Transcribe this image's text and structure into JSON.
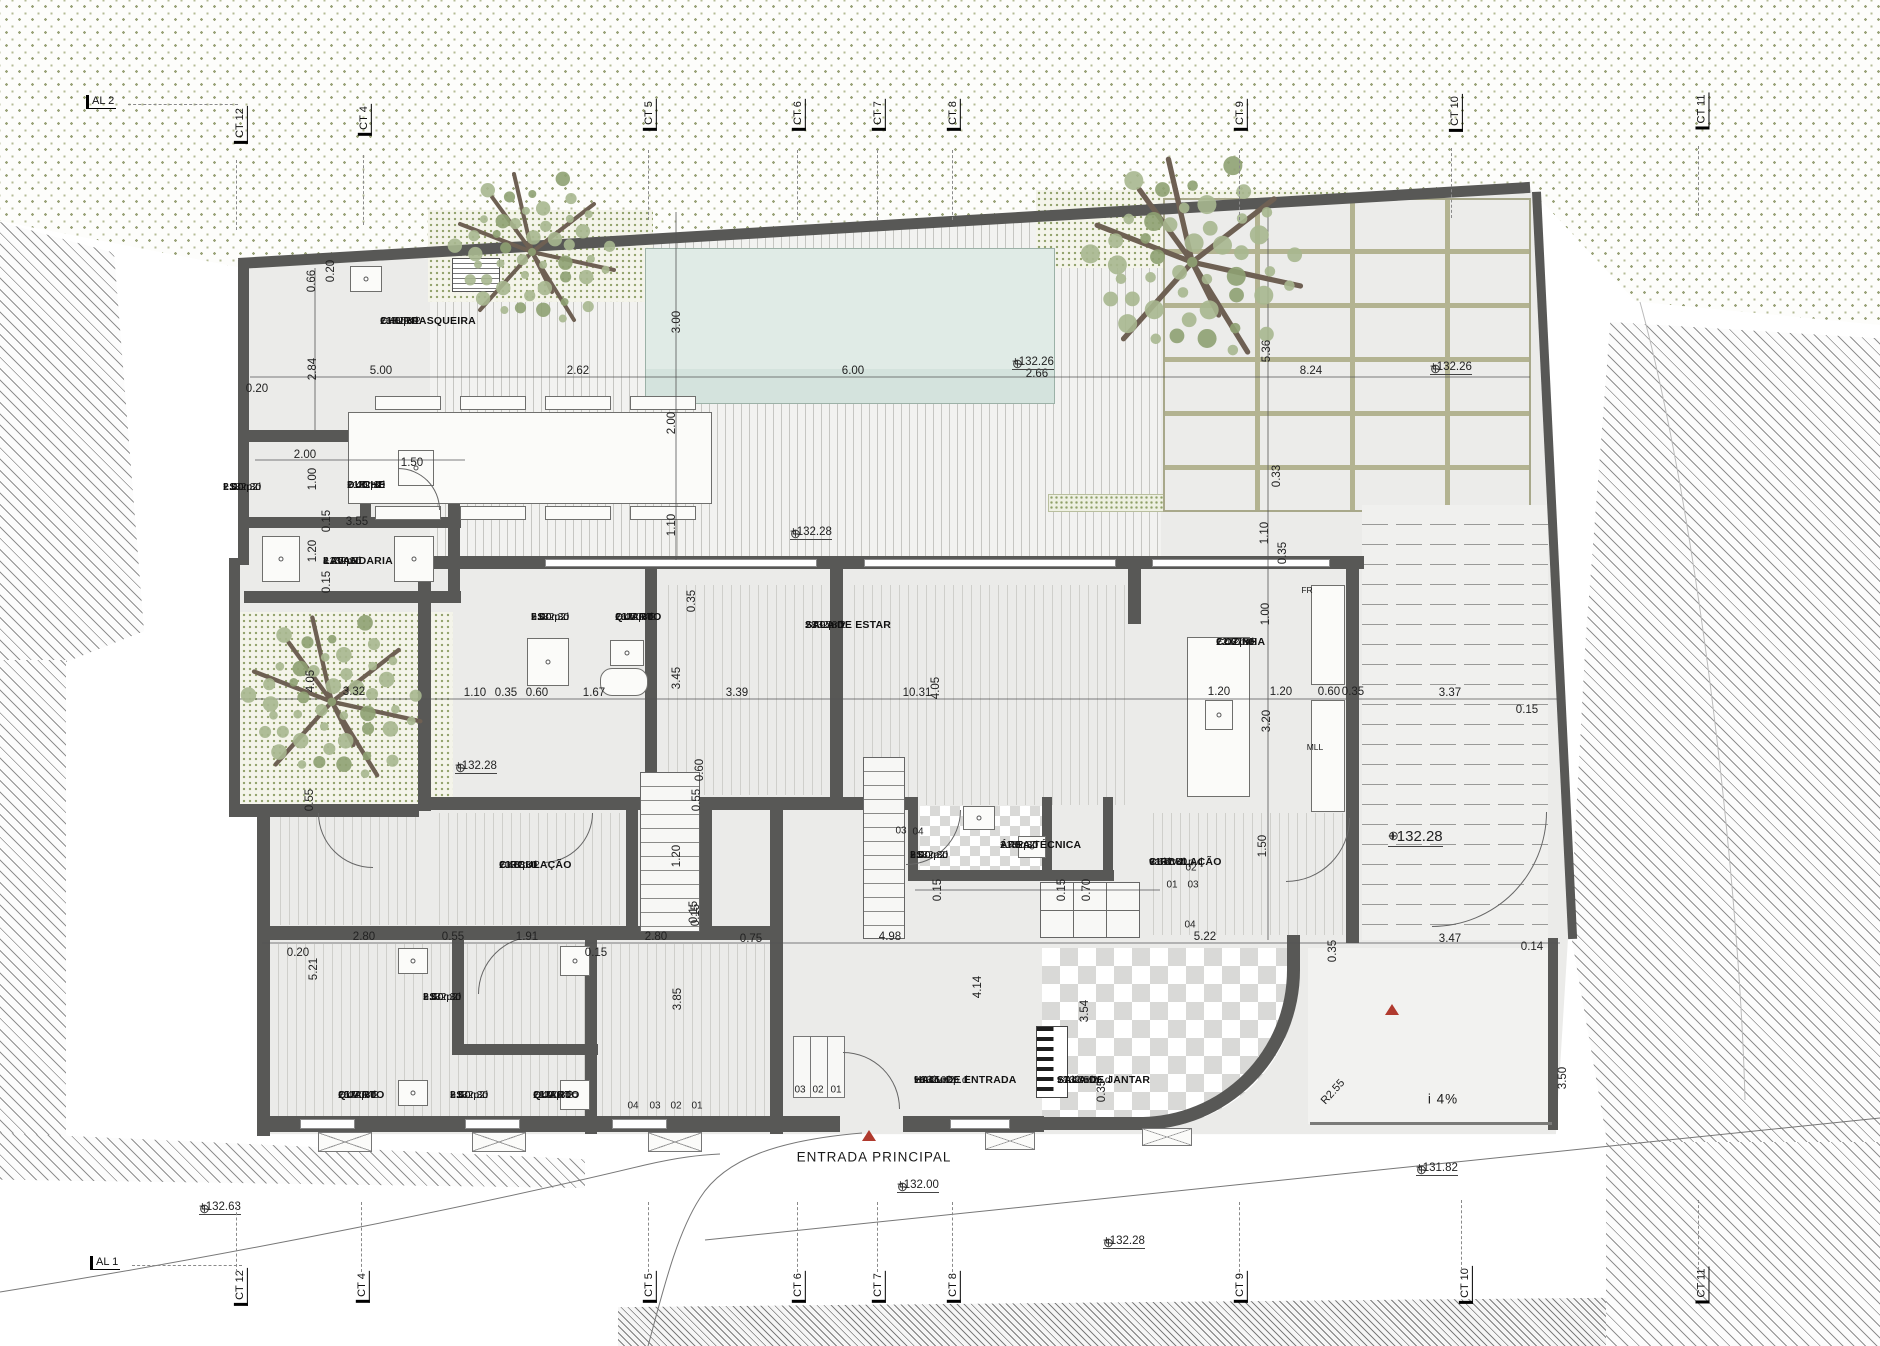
{
  "rooms": [
    {
      "name": "CHURRASQUEIRA",
      "area": "16.85m2",
      "pd": "2.40  p.d",
      "level": "+132.30",
      "x": 455,
      "y": 316
    },
    {
      "name": "I.S.",
      "area": "2.00m2",
      "pd": "2.40  p.d",
      "level": "+132.30",
      "x": 298,
      "y": 482
    },
    {
      "name": "DUCHE",
      "area": "1.45m2",
      "pd": "2.40  p.d",
      "level": "+132.30",
      "x": 422,
      "y": 480
    },
    {
      "name": "LAVANDARIA",
      "area": "4.25m2",
      "pd": "2.40  p.d",
      "level": "+132.30",
      "x": 398,
      "y": 556
    },
    {
      "name": "I.S.",
      "area": "5.00m2",
      "pd": "2.40  p.d",
      "level": "+132.30",
      "x": 606,
      "y": 612
    },
    {
      "name": "QUARTO",
      "area": "16.50m2",
      "pd": "2.40  p.d",
      "level": "+132.30",
      "x": 690,
      "y": 612
    },
    {
      "name": "SALA DE ESTAR",
      "area": "28.95m2",
      "pd": "2.40  p.d",
      "level": "+132.30",
      "x": 880,
      "y": 620
    },
    {
      "name": "COZINHA",
      "area": "12.37m2",
      "pd": "2.40  p.d",
      "level": "+132.30",
      "x": 1291,
      "y": 637
    },
    {
      "name": "CIRCULAÇÃO",
      "area": "10.38m2",
      "pd": "2.40  p.d",
      "level": "+132.30",
      "x": 574,
      "y": 860
    },
    {
      "name": "I.S.",
      "area": "3.00m2",
      "pd": "2.40  p.d",
      "level": "+132.30",
      "x": 985,
      "y": 850
    },
    {
      "name": "ÁREA TÉCNICA",
      "area": "1.43m2",
      "pd": "2.40  p.d",
      "level": "+132.30",
      "x": 1075,
      "y": 840
    },
    {
      "name": "CIRCULAÇÃO",
      "area": "9.67m2",
      "pd": "variável  p.d",
      "level": "+132.30",
      "x": 1224,
      "y": 857
    },
    {
      "name": "I.S.",
      "area": "3.50m2",
      "pd": "2.40  p.d",
      "level": "+132.30",
      "x": 498,
      "y": 992
    },
    {
      "name": "QUARTO",
      "area": "15.70m2",
      "pd": "2.40  p.d",
      "level": "+132.30",
      "x": 413,
      "y": 1090
    },
    {
      "name": "I.S.",
      "area": "3.50m2",
      "pd": "2.40  p.d",
      "level": "+132.30",
      "x": 525,
      "y": 1090
    },
    {
      "name": "QUARTO",
      "area": "11.90m2",
      "pd": "2.40  p.d",
      "level": "+132.30",
      "x": 608,
      "y": 1090
    },
    {
      "name": "HALL DE ENTRADA",
      "area": "16.45m2",
      "pd": "variável  p.d",
      "level": "+132.02",
      "x": 989,
      "y": 1075
    },
    {
      "name": "SALA DE JANTAR",
      "area": "17.43m2",
      "pd": "variável  p.d",
      "level": "+132.50",
      "x": 1132,
      "y": 1075
    }
  ],
  "dims": [
    {
      "t": "0.20",
      "x": 257,
      "y": 389
    },
    {
      "t": "5.00",
      "x": 381,
      "y": 371
    },
    {
      "t": "2.62",
      "x": 578,
      "y": 371
    },
    {
      "t": "6.00",
      "x": 853,
      "y": 371
    },
    {
      "t": "2.66",
      "x": 1037,
      "y": 374
    },
    {
      "t": "8.24",
      "x": 1311,
      "y": 371
    },
    {
      "t": "0.66",
      "x": 312,
      "y": 281,
      "r": 1
    },
    {
      "t": "0.20",
      "x": 331,
      "y": 271,
      "r": 1
    },
    {
      "t": "2.84",
      "x": 313,
      "y": 369,
      "r": 1
    },
    {
      "t": "3.00",
      "x": 677,
      "y": 322,
      "r": 1
    },
    {
      "t": "5.36",
      "x": 1267,
      "y": 351,
      "r": 1
    },
    {
      "t": "0.33",
      "x": 1277,
      "y": 476,
      "r": 1
    },
    {
      "t": "2.00",
      "x": 672,
      "y": 423,
      "r": 1
    },
    {
      "t": "1.10",
      "x": 672,
      "y": 525,
      "r": 1
    },
    {
      "t": "2.00",
      "x": 305,
      "y": 455
    },
    {
      "t": "1.50",
      "x": 412,
      "y": 463
    },
    {
      "t": "3.55",
      "x": 357,
      "y": 522
    },
    {
      "t": "0.15",
      "x": 327,
      "y": 521,
      "r": 1
    },
    {
      "t": "1.20",
      "x": 313,
      "y": 551,
      "r": 1
    },
    {
      "t": "0.15",
      "x": 327,
      "y": 582,
      "r": 1
    },
    {
      "t": "1.00",
      "x": 313,
      "y": 479,
      "r": 1
    },
    {
      "t": "3.32",
      "x": 354,
      "y": 692
    },
    {
      "t": "1.10",
      "x": 475,
      "y": 693
    },
    {
      "t": "0.35",
      "x": 506,
      "y": 693
    },
    {
      "t": "0.60",
      "x": 537,
      "y": 693
    },
    {
      "t": "1.67",
      "x": 594,
      "y": 693
    },
    {
      "t": "3.39",
      "x": 737,
      "y": 693
    },
    {
      "t": "10.31",
      "x": 917,
      "y": 693
    },
    {
      "t": "1.20",
      "x": 1219,
      "y": 692
    },
    {
      "t": "1.20",
      "x": 1281,
      "y": 692
    },
    {
      "t": "0.60",
      "x": 1329,
      "y": 692
    },
    {
      "t": "0.35",
      "x": 1353,
      "y": 692
    },
    {
      "t": "3.37",
      "x": 1450,
      "y": 693
    },
    {
      "t": "0.15",
      "x": 1527,
      "y": 710
    },
    {
      "t": "4.05",
      "x": 311,
      "y": 681,
      "r": 1
    },
    {
      "t": "3.45",
      "x": 677,
      "y": 678,
      "r": 1
    },
    {
      "t": "0.35",
      "x": 692,
      "y": 601,
      "r": 1
    },
    {
      "t": "4.05",
      "x": 936,
      "y": 688,
      "r": 1
    },
    {
      "t": "1.00",
      "x": 1266,
      "y": 614,
      "r": 1
    },
    {
      "t": "3.20",
      "x": 1267,
      "y": 721,
      "r": 1
    },
    {
      "t": "1.10",
      "x": 1265,
      "y": 533,
      "r": 1
    },
    {
      "t": "0.35",
      "x": 1283,
      "y": 553,
      "r": 1
    },
    {
      "t": "1.20",
      "x": 677,
      "y": 856,
      "r": 1
    },
    {
      "t": "0.15",
      "x": 696,
      "y": 915,
      "r": 1
    },
    {
      "t": "0.60",
      "x": 700,
      "y": 770,
      "r": 1
    },
    {
      "t": "0.55",
      "x": 310,
      "y": 800,
      "r": 1
    },
    {
      "t": "0.55",
      "x": 697,
      "y": 800,
      "r": 1
    },
    {
      "t": "1.50",
      "x": 1263,
      "y": 846,
      "r": 1
    },
    {
      "t": "0.70",
      "x": 1087,
      "y": 890,
      "r": 1
    },
    {
      "t": "0.15",
      "x": 1062,
      "y": 890,
      "r": 1
    },
    {
      "t": "0.15",
      "x": 938,
      "y": 890,
      "r": 1
    },
    {
      "t": "0.20",
      "x": 298,
      "y": 953
    },
    {
      "t": "2.80",
      "x": 364,
      "y": 937
    },
    {
      "t": "0.55",
      "x": 453,
      "y": 937
    },
    {
      "t": "1.91",
      "x": 527,
      "y": 937
    },
    {
      "t": "0.15",
      "x": 596,
      "y": 953
    },
    {
      "t": "2.80",
      "x": 656,
      "y": 937
    },
    {
      "t": "0.75",
      "x": 751,
      "y": 939
    },
    {
      "t": "4.98",
      "x": 890,
      "y": 937
    },
    {
      "t": "5.22",
      "x": 1205,
      "y": 937
    },
    {
      "t": "3.47",
      "x": 1450,
      "y": 939
    },
    {
      "t": "0.14",
      "x": 1532,
      "y": 947
    },
    {
      "t": "5.21",
      "x": 314,
      "y": 969,
      "r": 1
    },
    {
      "t": "3.85",
      "x": 678,
      "y": 999,
      "r": 1
    },
    {
      "t": "0.15",
      "x": 694,
      "y": 912,
      "r": 1
    },
    {
      "t": "4.14",
      "x": 978,
      "y": 987,
      "r": 1
    },
    {
      "t": "3.54",
      "x": 1085,
      "y": 1011,
      "r": 1
    },
    {
      "t": "0.35",
      "x": 1102,
      "y": 1091,
      "r": 1
    },
    {
      "t": "0.35",
      "x": 1333,
      "y": 951,
      "r": 1
    },
    {
      "t": "3.50",
      "x": 1563,
      "y": 1078,
      "r": 1
    }
  ],
  "levels": [
    {
      "t": "+132.26",
      "x": 1012,
      "y": 356
    },
    {
      "t": "+132.26",
      "x": 1430,
      "y": 361
    },
    {
      "t": "+132.28",
      "x": 790,
      "y": 526
    },
    {
      "t": "+132.28",
      "x": 455,
      "y": 760
    },
    {
      "t": "+132.28",
      "x": 1388,
      "y": 828,
      "big": 1
    },
    {
      "t": "+132.63",
      "x": 199,
      "y": 1201
    },
    {
      "t": "+132.00",
      "x": 897,
      "y": 1179
    },
    {
      "t": "+132.28",
      "x": 1103,
      "y": 1235
    },
    {
      "t": "+131.82",
      "x": 1416,
      "y": 1162
    }
  ],
  "grid_top": [
    {
      "t": "AL 2",
      "x": 86,
      "y": 95,
      "o": "h"
    },
    {
      "t": "CT 12",
      "x": 222,
      "y": 118,
      "o": "v"
    },
    {
      "t": "CT 4",
      "x": 349,
      "y": 113,
      "o": "v"
    },
    {
      "t": "CT 5",
      "x": 634,
      "y": 108,
      "o": "v"
    },
    {
      "t": "CT 6",
      "x": 783,
      "y": 108,
      "o": "v"
    },
    {
      "t": "CT 7",
      "x": 863,
      "y": 108,
      "o": "v"
    },
    {
      "t": "CT 8",
      "x": 938,
      "y": 108,
      "o": "v"
    },
    {
      "t": "CT 9",
      "x": 1225,
      "y": 108,
      "o": "v"
    },
    {
      "t": "CT 10",
      "x": 1437,
      "y": 106,
      "o": "v"
    },
    {
      "t": "CT 11",
      "x": 1684,
      "y": 104,
      "o": "v"
    }
  ],
  "grid_bottom": [
    {
      "t": "AL 1",
      "x": 90,
      "y": 1256,
      "o": "h"
    },
    {
      "t": "CT 12",
      "x": 222,
      "y": 1280,
      "o": "v"
    },
    {
      "t": "CT 4",
      "x": 347,
      "y": 1280,
      "o": "v"
    },
    {
      "t": "CT 5",
      "x": 634,
      "y": 1280,
      "o": "v"
    },
    {
      "t": "CT 6",
      "x": 783,
      "y": 1280,
      "o": "v"
    },
    {
      "t": "CT 7",
      "x": 863,
      "y": 1280,
      "o": "v"
    },
    {
      "t": "CT 8",
      "x": 938,
      "y": 1280,
      "o": "v"
    },
    {
      "t": "CT 9",
      "x": 1225,
      "y": 1280,
      "o": "v"
    },
    {
      "t": "CT 10",
      "x": 1447,
      "y": 1278,
      "o": "v"
    },
    {
      "t": "CT 11",
      "x": 1684,
      "y": 1278,
      "o": "v"
    }
  ],
  "notes": [
    {
      "t": "ENTRADA  PRINCIPAL",
      "x": 874,
      "y": 1157,
      "cls": ""
    },
    {
      "t": "i  4%",
      "x": 1443,
      "y": 1099,
      "cls": ""
    },
    {
      "t": "R2.55",
      "x": 1333,
      "y": 1092,
      "cls": "r45"
    },
    {
      "t": "FR",
      "x": 1307,
      "y": 590,
      "cls": "small"
    },
    {
      "t": "MLL",
      "x": 1315,
      "y": 747,
      "cls": "small"
    }
  ],
  "steps": [
    {
      "t": "03",
      "x": 901,
      "y": 831
    },
    {
      "t": "04",
      "x": 918,
      "y": 832
    },
    {
      "t": "02",
      "x": 1191,
      "y": 868
    },
    {
      "t": "01",
      "x": 1172,
      "y": 885
    },
    {
      "t": "03",
      "x": 1193,
      "y": 885
    },
    {
      "t": "04",
      "x": 1190,
      "y": 925
    },
    {
      "t": "03",
      "x": 800,
      "y": 1090
    },
    {
      "t": "02",
      "x": 818,
      "y": 1090
    },
    {
      "t": "01",
      "x": 836,
      "y": 1090
    },
    {
      "t": "04",
      "x": 633,
      "y": 1106
    },
    {
      "t": "03",
      "x": 655,
      "y": 1106
    },
    {
      "t": "02",
      "x": 676,
      "y": 1106
    },
    {
      "t": "01",
      "x": 697,
      "y": 1106
    }
  ],
  "entrance_triangles": [
    {
      "x": 862,
      "y": 1130
    },
    {
      "x": 1385,
      "y": 1004
    }
  ]
}
